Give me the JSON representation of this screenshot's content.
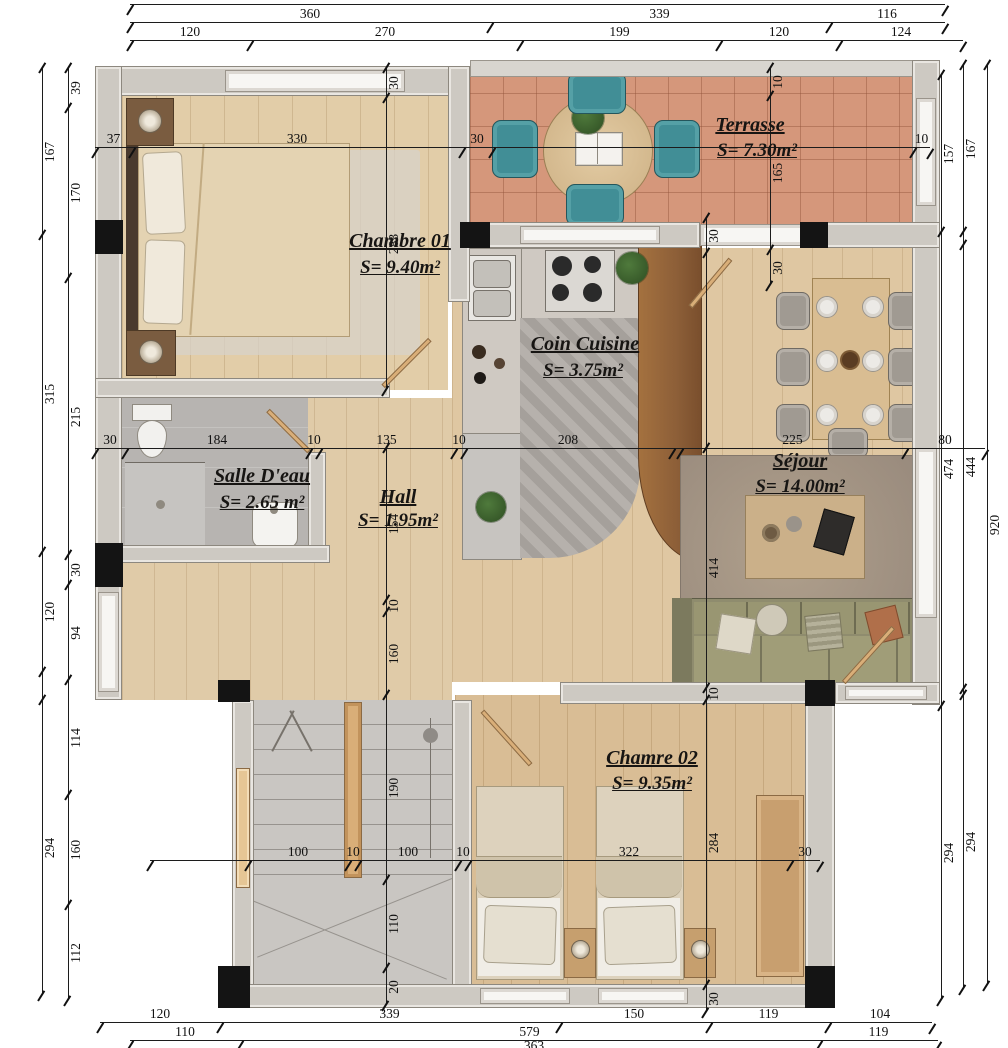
{
  "rooms": {
    "chambre01": {
      "name": "Chambre 01",
      "area": "S= 9.40m²"
    },
    "terrasse": {
      "name": "Terrasse",
      "area": "S= 7.30m²"
    },
    "cuisine": {
      "name": "Coin Cuisine",
      "area": "S= 3.75m²"
    },
    "salledeau": {
      "name": "Salle D'eau",
      "area": "S= 2.65 m²"
    },
    "hall": {
      "name": "Hall",
      "area": "S= 1.95m²"
    },
    "sejour": {
      "name": "Séjour",
      "area": "S= 14.00m²"
    },
    "chambre02": {
      "name": "Chamre 02",
      "area": "S= 9.35m²"
    }
  },
  "dims": {
    "top_partial": "815",
    "top1": [
      "360",
      "339",
      "116"
    ],
    "top2": [
      "120",
      "270",
      "199",
      "120",
      "124"
    ],
    "bottom1": [
      "120",
      "339",
      "150",
      "119",
      "104"
    ],
    "bottom2": [
      "110",
      "579",
      "119"
    ],
    "bottom_partial": "363",
    "left_outer": [
      "167",
      "315",
      "120",
      "294"
    ],
    "left_inner": [
      "39",
      "170",
      "215",
      "30",
      "94",
      "114",
      "160",
      "112"
    ],
    "right_inner": [
      "157",
      "474",
      "294"
    ],
    "right_mid": [
      "167",
      "444",
      "294"
    ],
    "right_outer": [
      "920"
    ],
    "h_top": [
      "37",
      "330",
      "30",
      "10"
    ],
    "h_mid": [
      "30",
      "184",
      "10",
      "135",
      "10",
      "208",
      "225",
      "80"
    ],
    "h_stairs": [
      "100",
      "10",
      "100",
      "10",
      "322",
      "30"
    ],
    "v_ch1": [
      "30",
      "283"
    ],
    "v_terr": [
      "10",
      "165",
      "30"
    ],
    "v_hall": [
      "154",
      "10",
      "160",
      "190",
      "110",
      "20"
    ],
    "v_right": [
      "30",
      "414",
      "10",
      "284",
      "30"
    ]
  },
  "colors": {
    "wood_light": "#e2cda8",
    "wood_mid": "#dfc7a2",
    "wood_dark_walnut": "#8d5f38",
    "terracotta": "#d5977b",
    "wall_gray": "#cdc9c2",
    "column_black": "#141414",
    "bath_gray": "#b7b4b1",
    "stairs_gray": "#c9c6c2",
    "teal_chair": "#418e96",
    "sofa_olive": "#8f8c6e",
    "rug_brown": "#a2927f",
    "dim_line": "#1c1c1c"
  }
}
